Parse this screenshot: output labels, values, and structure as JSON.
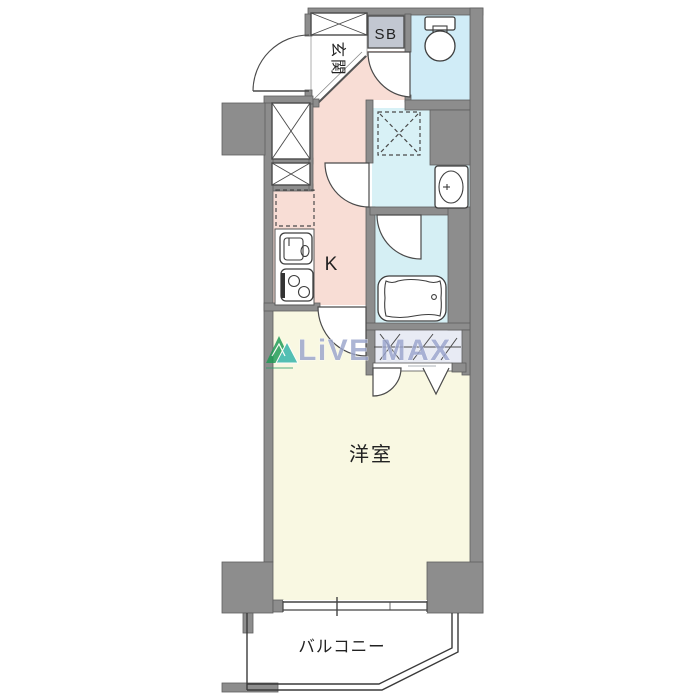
{
  "floorplan": {
    "rooms": {
      "entrance": "玄関",
      "shoebox": "SB",
      "kitchen": "K",
      "western_room": "洋室",
      "balcony": "バルコニー"
    },
    "watermark": {
      "brand": "LiVE MAX"
    },
    "colors": {
      "wall": "#8d8d8d",
      "hall_pink": "#f8ddd5",
      "wet_area_cyan": "#d3edf6",
      "room_cream": "#f9f8e2",
      "closet": "#e8ebf4",
      "shoebox_gray": "#c2c7d1",
      "watermark_blue": "#9aa5cd",
      "logo_green": "#1c9b55",
      "logo_teal": "#2fb3a9"
    },
    "fixtures": [
      "toilet",
      "washbasin",
      "bathtub",
      "kitchen-sink",
      "gas-stove",
      "washing-machine-space",
      "refrigerator-space",
      "pipe-shaft",
      "closet",
      "entrance-door",
      "window",
      "balcony-rail"
    ]
  }
}
